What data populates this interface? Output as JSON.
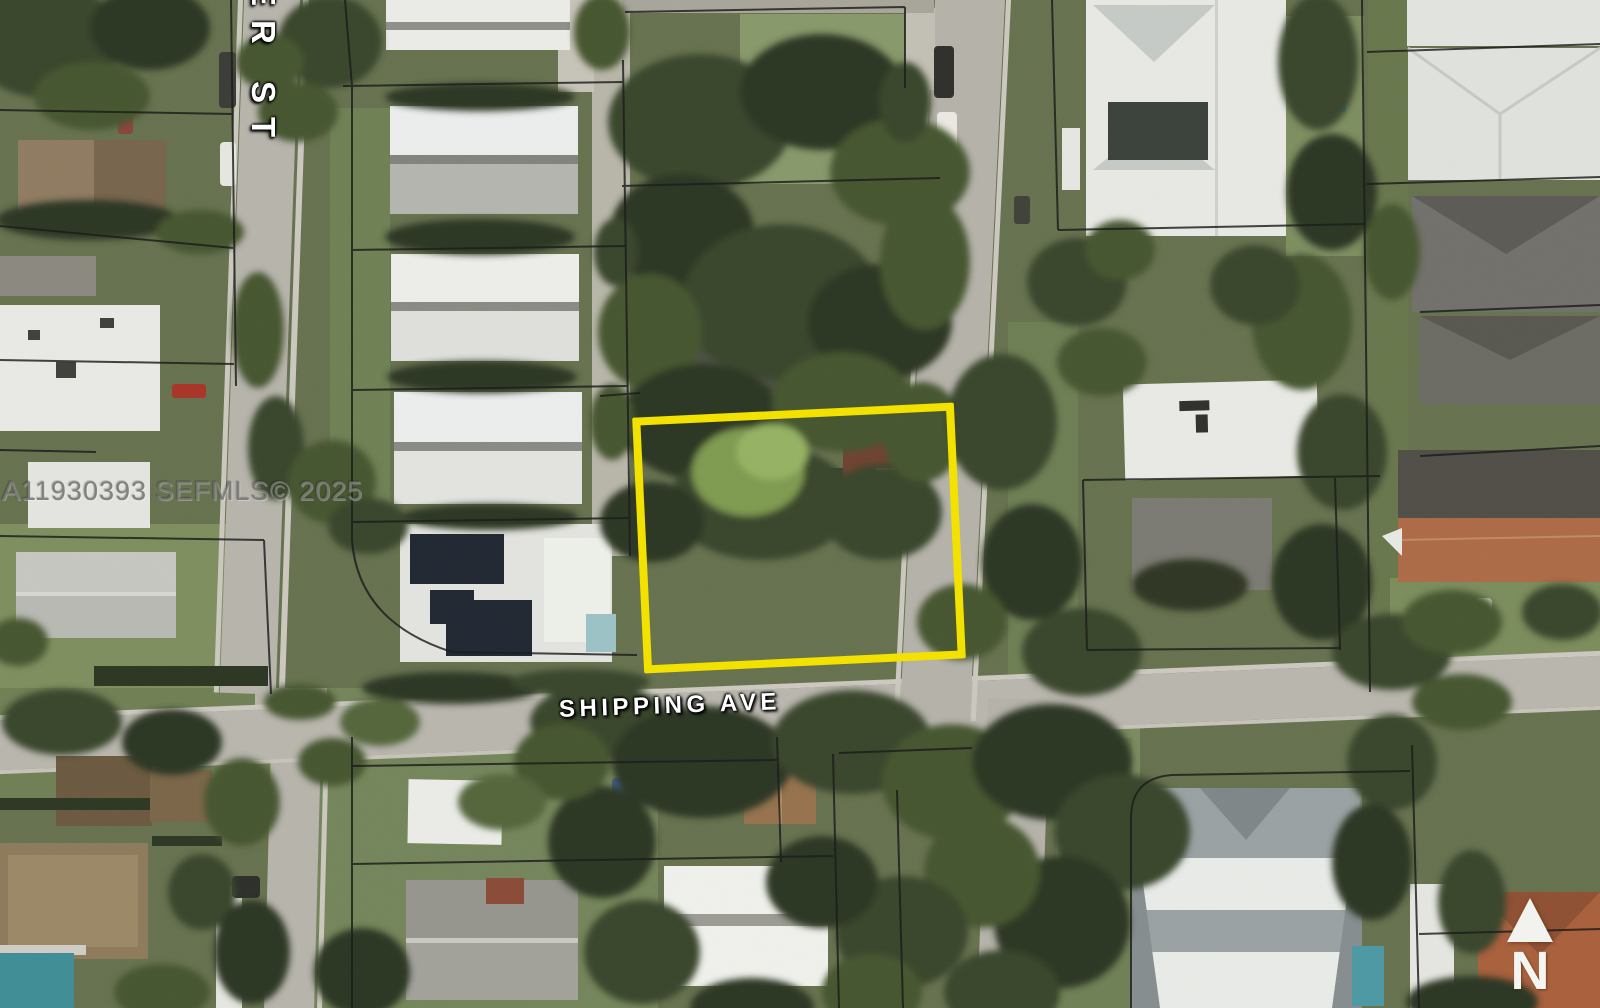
{
  "watermark": {
    "text": "A11930393  SEFMLS© 2025"
  },
  "street_labels": {
    "vertical_street": "ER ST",
    "horizontal_street": "SHIPPING AVE"
  },
  "north_indicator": {
    "label": "N"
  },
  "annotation_colors": {
    "highlighted_parcel_outline": "#F3E100",
    "parcel_lines": "#191919",
    "street_label_text": "#FFFFFF"
  }
}
